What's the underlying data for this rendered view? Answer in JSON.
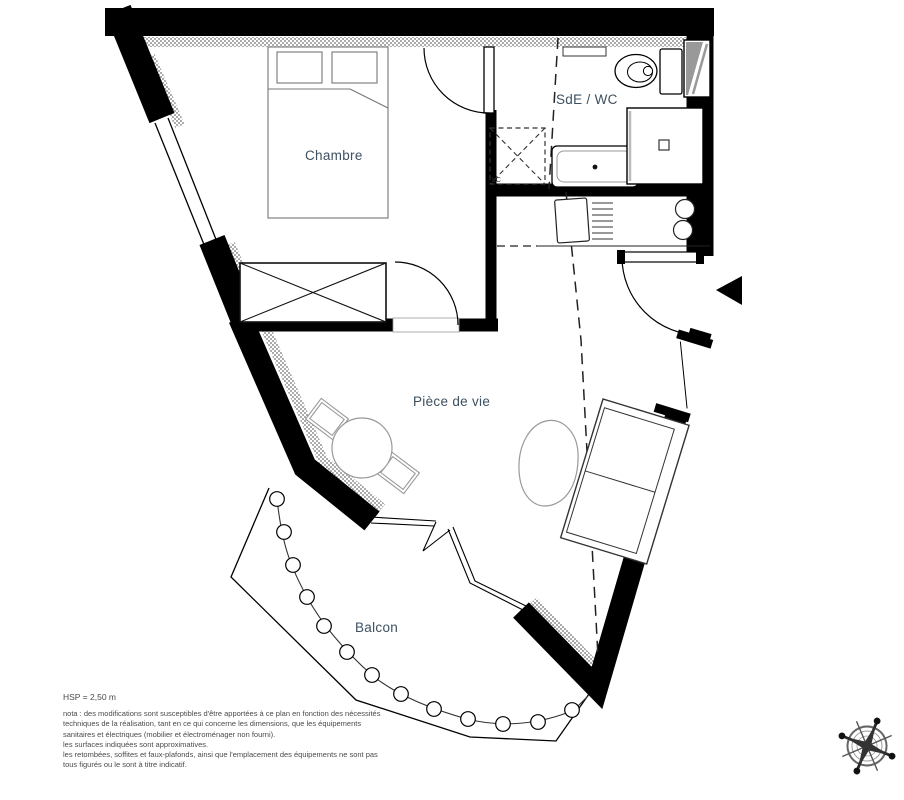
{
  "plan": {
    "labels": {
      "bedroom": "Chambre",
      "bathroom": "SdE / WC",
      "living": "Pièce de vie",
      "balcony": "Balcon",
      "washer": "LC"
    },
    "colors": {
      "wall": "#000000",
      "hatch": "#8a8a8a",
      "label_text": "#3d5060",
      "note_text": "#4a4a4a"
    }
  },
  "notes": {
    "ceiling_height": "HSP = 2,50 m",
    "lines": [
      "nota : des modifications sont susceptibles d'être apportées à ce plan en fonction des nécessités",
      "techniques de la réalisation, tant en ce qui concerne les dimensions, que les équipements",
      "sanitaires et électriques (mobilier et électroménager non fourni).",
      "les surfaces indiquées sont approximatives.",
      "les retombées, soffites et faux-plafonds, ainsi que l'emplacement des équipements ne sont pas",
      "tous figurés ou le sont à titre indicatif."
    ]
  }
}
